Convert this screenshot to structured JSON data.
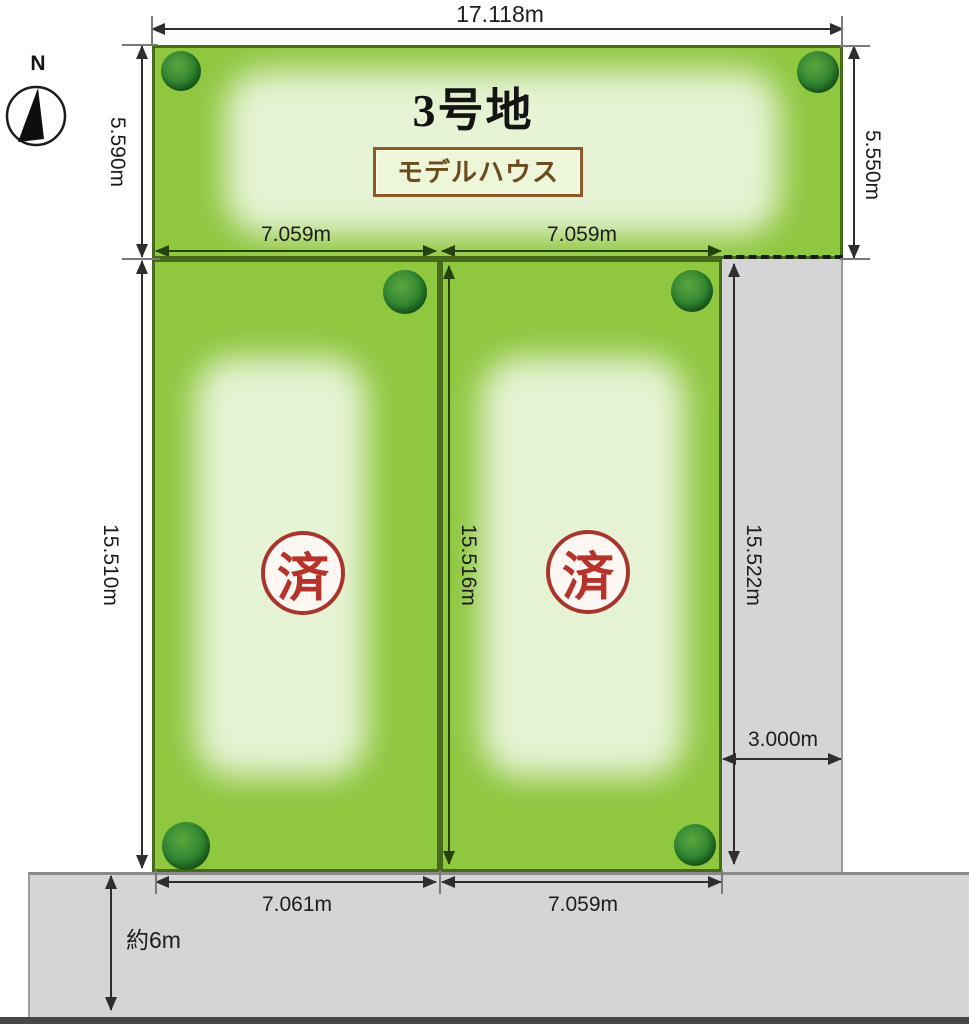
{
  "compass": {
    "north_label": "N"
  },
  "lot3": {
    "name": "3号地",
    "tag": "モデルハウス"
  },
  "lot_left": {
    "stamp": "済"
  },
  "lot_right": {
    "stamp": "済"
  },
  "dims": {
    "top_width": "17.118m",
    "lot3_left_depth": "5.590m",
    "lot3_right_depth": "5.550m",
    "lot_left_width": "7.059m",
    "lot_right_width": "7.059m",
    "lot_left_depth": "15.510m",
    "lot_center_depth": "15.516m",
    "strip_depth": "15.522m",
    "strip_width": "3.000m",
    "lot_left_bottom_width": "7.061m",
    "lot_right_bottom_width": "7.059m",
    "road_width": "約6m"
  },
  "colors": {
    "lot_green": "#8fc73f",
    "lot_border_green": "#47691b",
    "road_gray": "#d5d5d5",
    "stamp_red": "#b5332a",
    "tag_brown": "#8e5a28",
    "dim_line_dark": "#2e2e2e"
  }
}
